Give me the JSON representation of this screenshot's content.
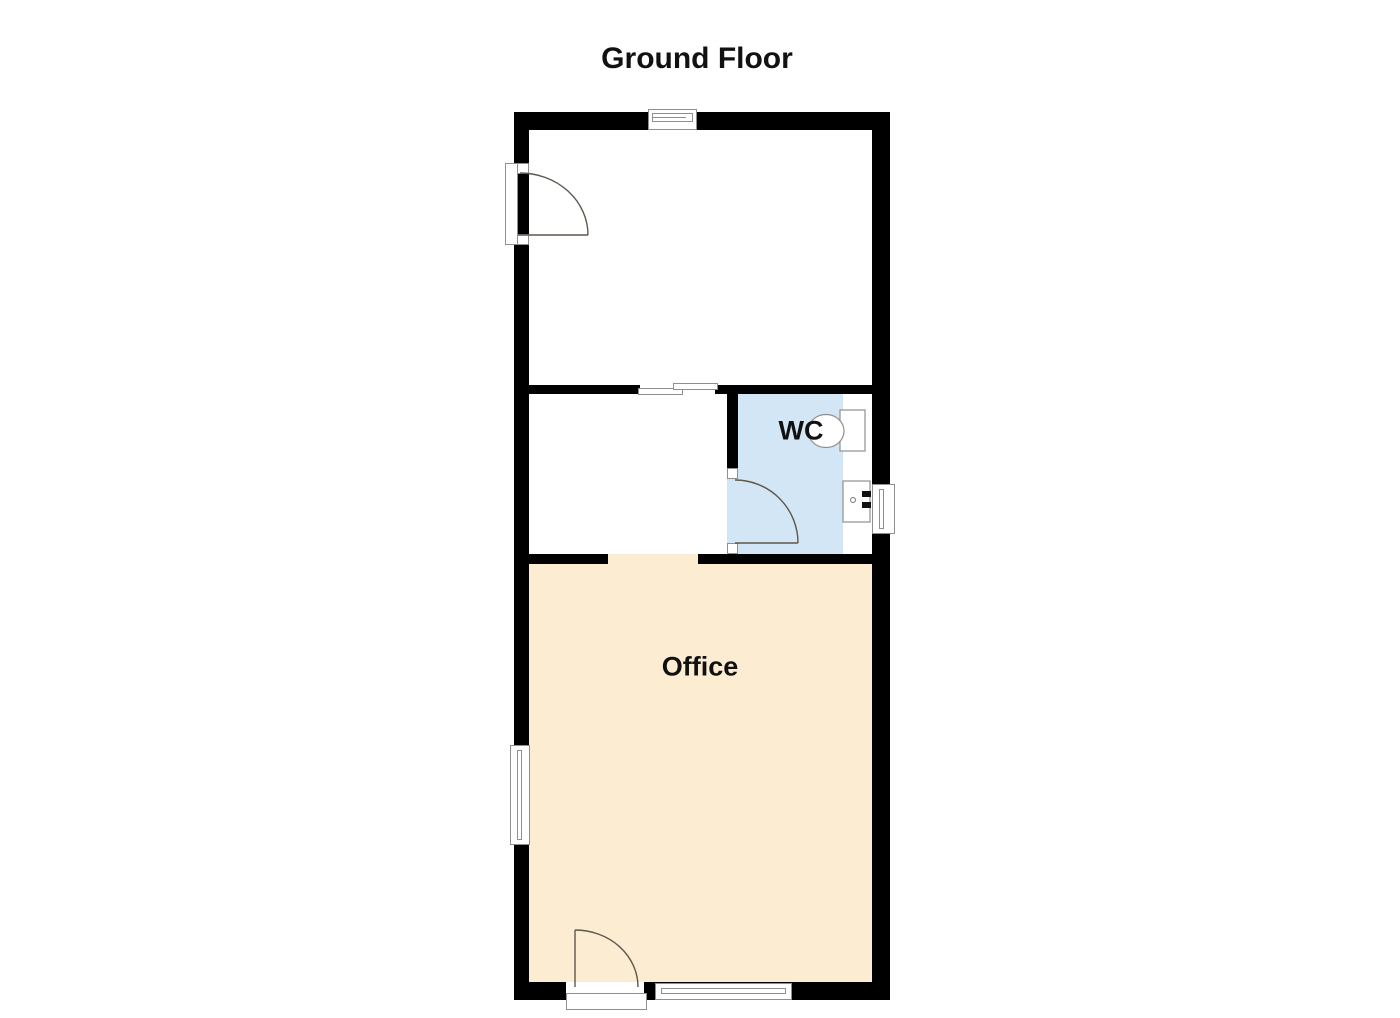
{
  "title": "Ground Floor",
  "rooms": {
    "office": {
      "label": "Office"
    },
    "wc": {
      "label": "WC"
    }
  },
  "colors": {
    "wall": "#000000",
    "wc_floor": "#d3e6f6",
    "office_floor": "#fbecd2",
    "fixture_outline": "#8f8f8f",
    "door_arc": "#5f574b"
  }
}
